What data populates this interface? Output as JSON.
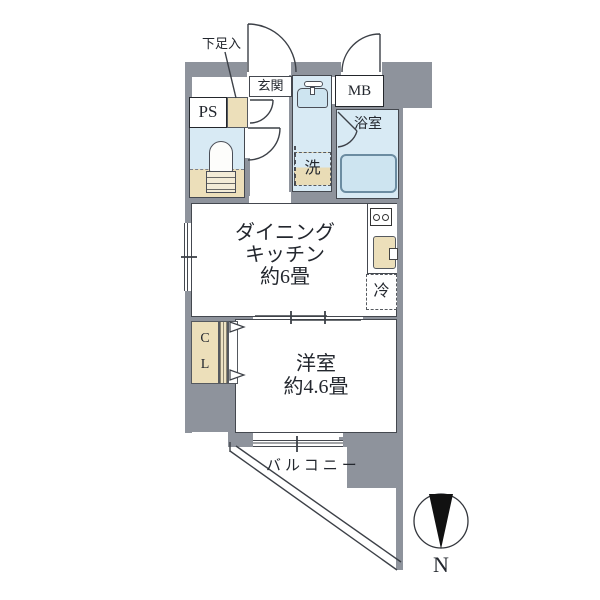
{
  "title": "apartment-floor-plan",
  "colors": {
    "wall": "#8e939c",
    "wet": "#d8eaf4",
    "fix": "#cde4f0",
    "beige": "#ecdfba",
    "line": "#44484f",
    "text": "#23272e",
    "north": "#111111"
  },
  "rooms": {
    "shoe_cabinet": {
      "label": "下足入"
    },
    "entrance": {
      "label": "玄関"
    },
    "pipe_space": {
      "label": "PS"
    },
    "meter_box": {
      "label": "MB"
    },
    "bathroom": {
      "label": "浴室"
    },
    "laundry": {
      "label": "洗"
    },
    "dining_kitchen": {
      "line1": "ダイニング",
      "line2": "キッチン",
      "line3": "約6畳"
    },
    "refrigerator": {
      "label": "冷"
    },
    "closet": {
      "line1": "C",
      "line2": "L"
    },
    "bedroom": {
      "line1": "洋室",
      "line2": "約4.6畳"
    },
    "balcony": {
      "label": "バルコニー"
    }
  },
  "compass": {
    "label": "N"
  }
}
